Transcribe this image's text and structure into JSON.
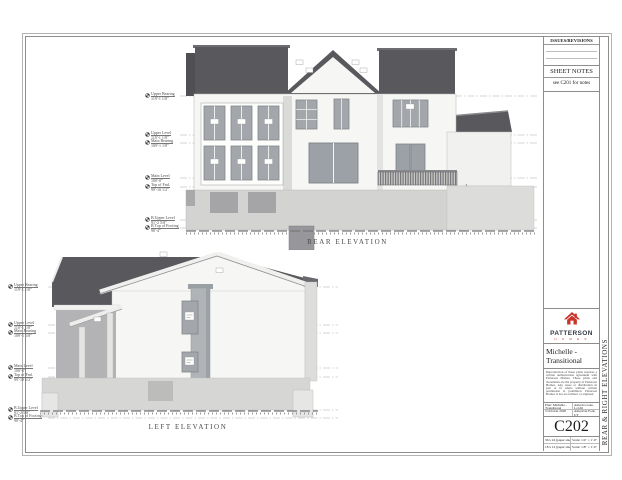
{
  "sheet": {
    "labels": {
      "rear": "REAR ELEVATION",
      "left": "LEFT ELEVATION"
    }
  },
  "levels": [
    {
      "name": "Upper Bearing",
      "elev": "119'-1 1/8\""
    },
    {
      "name": "Upper Level",
      "elev": "110'-1 1/8\""
    },
    {
      "name": "Main Bearing",
      "elev": "109'-1 1/8\""
    },
    {
      "name": "Main Level",
      "elev": "100'-0\""
    },
    {
      "name": "Top of Fnd.",
      "elev": "99'-10 1/2\""
    },
    {
      "name": "B.Upper Level",
      "elev": "91'-2 5/8\""
    },
    {
      "name": "B.Top of Footing",
      "elev": "90'-4\""
    }
  ],
  "titleblock": {
    "issues": {
      "title": "ISSUES/REVISIONS"
    },
    "sheet_notes": {
      "title": "SHEET NOTES",
      "note": "see C201 for notes"
    },
    "logo": {
      "word": "PATTERSON",
      "sub": "H O M E S"
    },
    "plan_title": "Michelle - Transitional",
    "disclaimer": "Reproduction of these plans requires a written authorization agreement with Patterson Homes. These plans and documents are the property of Patterson Homes. Any reuse or distribution in part or in whole without written permission is prohibited. Patterson Homes is not an architect or engineer.",
    "info": {
      "plan": "Plan: Michelle - Transitional",
      "date": "3 October 2020",
      "lot": "America Gate, Lot ##",
      "city": "American Fork, UT"
    },
    "sheet_number": "C202",
    "paper": [
      {
        "size": "36 x 24 (paper size)",
        "scale": "Scale: 1/4\" = 1'-0\""
      },
      {
        "size": "18 x 12 (paper size)",
        "scale": "Scale: 1/8\" = 1'-0\""
      }
    ],
    "vertical_title": "REAR & RIGHT ELEVATIONS"
  },
  "colors": {
    "accent_red": "#c9352b",
    "roof": "#58585d",
    "wall": "#f6f6f4",
    "window": "#a3a7ab",
    "foundation": "#d3d3d1"
  }
}
